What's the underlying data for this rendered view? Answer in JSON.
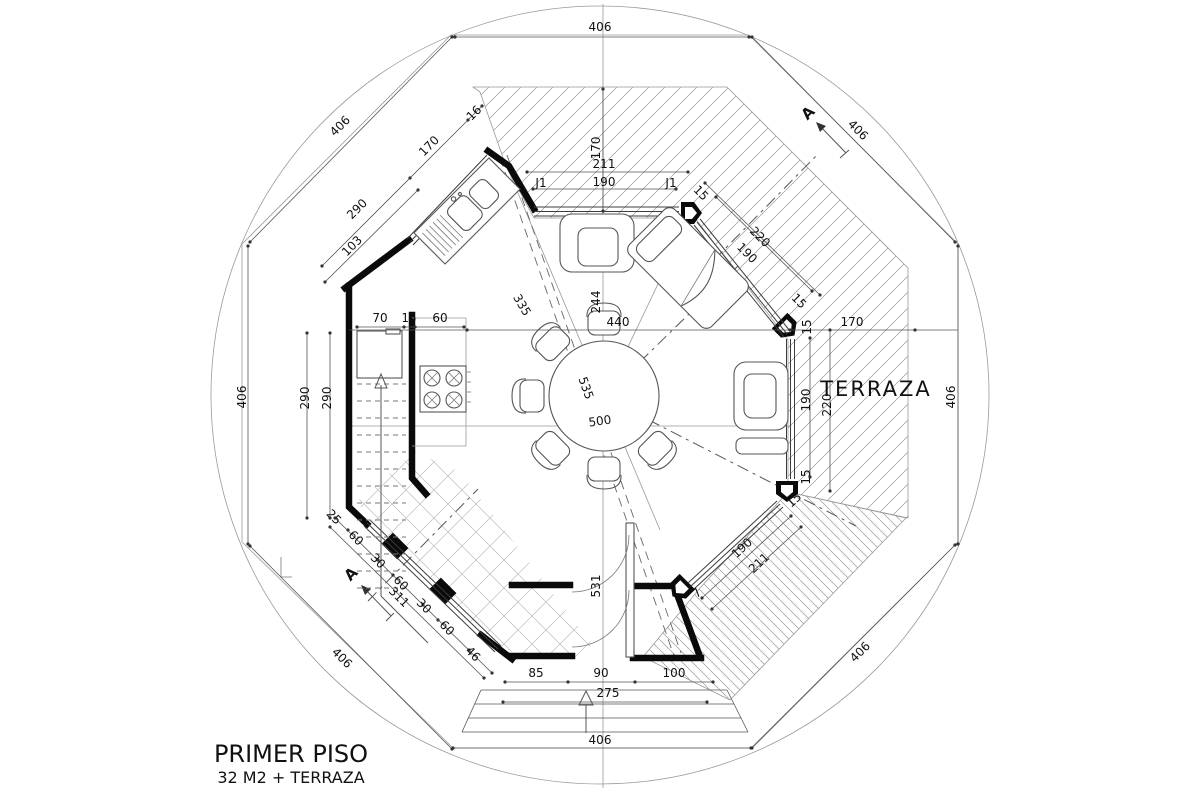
{
  "title": {
    "line1": "PRIMER PISO",
    "line2": "32 M2 + TERRAZA"
  },
  "room_labels": {
    "terraza": "TERRAZA"
  },
  "section_marker": {
    "label": "A"
  },
  "window_tags": {
    "j1": "J1"
  },
  "dims": {
    "v406": "406",
    "v290": "290",
    "v170": "170",
    "v211": "211",
    "v190": "190",
    "v220": "220",
    "v244": "244",
    "v335": "335",
    "v440": "440",
    "v500": "500",
    "v535": "535",
    "v531": "531",
    "v103": "103",
    "v70": "70",
    "v60": "60",
    "v30": "30",
    "v25": "25",
    "v15": "15",
    "v16": "16",
    "v46": "46",
    "v311": "311",
    "v85": "85",
    "v90": "90",
    "v100": "100",
    "v275": "275",
    "v7": "7"
  },
  "drawing": {
    "type": "floor-plan",
    "shape": "octagon inscribed in circle",
    "rooms": [
      "kitchen",
      "dining",
      "stairs",
      "terraza",
      "entry"
    ],
    "outer_edge_length": "406",
    "hatched_zones": [
      "terraza-roof-top",
      "terraza-right",
      "deck-bottom-right"
    ]
  },
  "colors": {
    "line": "#555555",
    "wall": "#0a0a0a",
    "construction": "#9a9a9a",
    "background": "#ffffff"
  }
}
